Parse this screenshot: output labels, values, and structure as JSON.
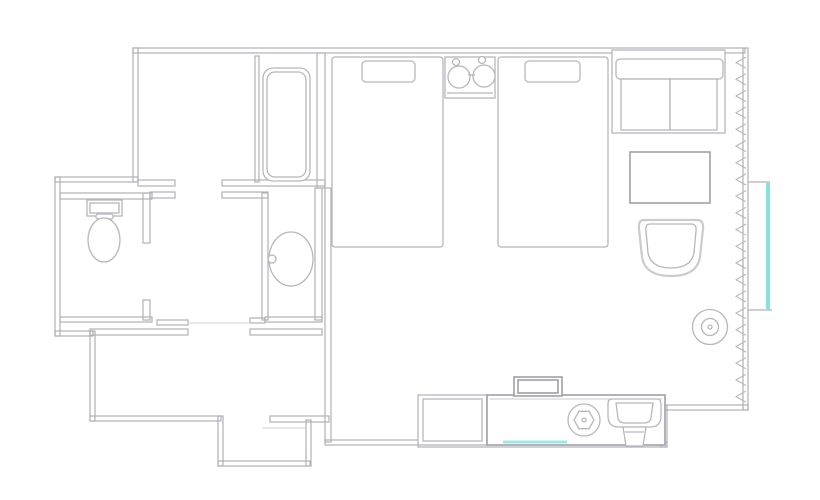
{
  "page": {
    "width": 820,
    "height": 500,
    "background": "#ffffff"
  },
  "colors": {
    "wall": "#b0b1b7",
    "furniture": "#b6b7bd",
    "furniture_dark": "#9fa0a7",
    "soft_outline": "#cbcbd0",
    "door_line": "#dcdcdf",
    "window_glass": "#82e3e0",
    "mirror_glass": "#9fe8e4"
  },
  "floorplan": {
    "type": "hotel-room-floor-plan",
    "elements": [
      {
        "name": "walls",
        "class": "wall",
        "shapes": [
          {
            "t": "rect",
            "x": 133,
            "y": 48,
            "w": 612,
            "h": 5
          },
          {
            "t": "rect",
            "x": 743,
            "y": 48,
            "w": 5,
            "h": 362
          },
          {
            "t": "rect",
            "x": 665,
            "y": 405,
            "w": 83,
            "h": 5
          },
          {
            "t": "rect",
            "x": 661,
            "y": 405,
            "w": 6,
            "h": 42
          },
          {
            "t": "rect",
            "x": 418,
            "y": 442,
            "w": 249,
            "h": 5
          },
          {
            "t": "rect",
            "x": 325,
            "y": 440,
            "w": 95,
            "h": 5
          },
          {
            "t": "rect",
            "x": 325,
            "y": 188,
            "w": 6,
            "h": 254
          },
          {
            "t": "rect",
            "x": 133,
            "y": 48,
            "w": 5,
            "h": 134
          },
          {
            "t": "rect",
            "x": 55,
            "y": 177,
            "w": 83,
            "h": 5
          },
          {
            "t": "rect",
            "x": 55,
            "y": 177,
            "w": 5,
            "h": 159
          },
          {
            "t": "rect",
            "x": 55,
            "y": 331,
            "w": 38,
            "h": 5
          },
          {
            "t": "rect",
            "x": 90,
            "y": 331,
            "w": 5,
            "h": 90
          },
          {
            "t": "rect",
            "x": 90,
            "y": 416,
            "w": 131,
            "h": 5
          },
          {
            "t": "rect",
            "x": 218,
            "y": 416,
            "w": 5,
            "h": 50
          },
          {
            "t": "rect",
            "x": 218,
            "y": 461,
            "w": 92,
            "h": 5
          },
          {
            "t": "rect",
            "x": 306,
            "y": 420,
            "w": 5,
            "h": 46
          },
          {
            "t": "rect",
            "x": 270,
            "y": 416,
            "w": 59,
            "h": 6
          },
          {
            "t": "rect",
            "x": 90,
            "y": 329,
            "w": 98,
            "h": 6
          },
          {
            "t": "rect",
            "x": 250,
            "y": 329,
            "w": 72,
            "h": 6
          },
          {
            "t": "rect",
            "x": 60,
            "y": 317,
            "w": 92,
            "h": 5
          },
          {
            "t": "rect",
            "x": 157,
            "y": 320,
            "w": 31,
            "h": 5
          },
          {
            "t": "rect",
            "x": 250,
            "y": 318,
            "w": 15,
            "h": 5
          },
          {
            "t": "rect",
            "x": 265,
            "y": 317,
            "w": 57,
            "h": 5
          },
          {
            "t": "rect",
            "x": 60,
            "y": 193,
            "w": 92,
            "h": 6
          },
          {
            "t": "rect",
            "x": 143,
            "y": 193,
            "w": 7,
            "h": 50
          },
          {
            "t": "rect",
            "x": 143,
            "y": 300,
            "w": 7,
            "h": 20
          },
          {
            "t": "rect",
            "x": 262,
            "y": 193,
            "w": 6,
            "h": 127
          },
          {
            "t": "rect",
            "x": 315,
            "y": 188,
            "w": 7,
            "h": 132
          },
          {
            "t": "rect",
            "x": 317,
            "y": 53,
            "w": 8,
            "h": 135
          },
          {
            "t": "rect",
            "x": 138,
            "y": 180,
            "w": 37,
            "h": 6
          },
          {
            "t": "rect",
            "x": 222,
            "y": 180,
            "w": 103,
            "h": 6
          },
          {
            "t": "rect",
            "x": 150,
            "y": 192,
            "w": 25,
            "h": 6
          },
          {
            "t": "rect",
            "x": 222,
            "y": 192,
            "w": 46,
            "h": 6
          },
          {
            "t": "rect",
            "x": 255,
            "y": 56,
            "w": 4,
            "h": 126
          }
        ]
      },
      {
        "name": "door-openings",
        "class": "door",
        "shapes": [
          {
            "t": "line",
            "x1": 188,
            "y1": 323,
            "x2": 250,
            "y2": 323
          },
          {
            "t": "line",
            "x1": 262,
            "y1": 428,
            "x2": 305,
            "y2": 428
          }
        ]
      },
      {
        "name": "bathtub",
        "class": "furn",
        "shapes": [
          {
            "t": "rect",
            "x": 263,
            "y": 68,
            "w": 47,
            "h": 113,
            "rx": 10,
            "f": "#ffffff"
          },
          {
            "t": "rect",
            "x": 267,
            "y": 72,
            "w": 39,
            "h": 105,
            "rx": 8
          }
        ]
      },
      {
        "name": "toilet",
        "class": "furn",
        "shapes": [
          {
            "t": "rect",
            "x": 87,
            "y": 200,
            "w": 35,
            "h": 16,
            "f": "#ffffff"
          },
          {
            "t": "rect",
            "x": 90,
            "y": 203,
            "w": 29,
            "h": 10
          },
          {
            "t": "rect",
            "x": 96,
            "y": 214,
            "w": 17,
            "h": 5,
            "rx": 2,
            "f": "#ffffff"
          },
          {
            "t": "ellipse",
            "cx": 104,
            "cy": 240,
            "rx": 16,
            "ry": 22,
            "f": "#ffffff"
          }
        ]
      },
      {
        "name": "washbasin",
        "class": "furn",
        "shapes": [
          {
            "t": "ellipse",
            "cx": 291,
            "cy": 259,
            "rx": 22,
            "ry": 27,
            "f": "#ffffff"
          },
          {
            "t": "circle",
            "cx": 272,
            "cy": 259,
            "r": 4,
            "f": "#ffffff"
          }
        ]
      },
      {
        "name": "bed-1",
        "class": "furn",
        "shapes": [
          {
            "t": "rect",
            "x": 332,
            "y": 57,
            "w": 111,
            "h": 190,
            "rx": 3,
            "f": "#ffffff"
          },
          {
            "t": "rect",
            "x": 362,
            "y": 61,
            "w": 53,
            "h": 21,
            "rx": 4,
            "f": "#ffffff"
          }
        ]
      },
      {
        "name": "bed-2",
        "class": "furn",
        "shapes": [
          {
            "t": "rect",
            "x": 498,
            "y": 57,
            "w": 110,
            "h": 190,
            "rx": 3,
            "f": "#ffffff"
          },
          {
            "t": "rect",
            "x": 525,
            "y": 61,
            "w": 55,
            "h": 21,
            "rx": 4,
            "f": "#ffffff"
          }
        ]
      },
      {
        "name": "nightstand-lamps",
        "class": "furn",
        "shapes": [
          {
            "t": "rect",
            "x": 445,
            "y": 57,
            "w": 50,
            "h": 41,
            "f": "#ffffff"
          },
          {
            "t": "line",
            "x1": 447,
            "y1": 93,
            "x2": 493,
            "y2": 93
          },
          {
            "t": "circle",
            "cx": 459,
            "cy": 77,
            "r": 11,
            "f": "#ffffff"
          },
          {
            "t": "circle",
            "cx": 484,
            "cy": 76,
            "r": 11,
            "f": "#ffffff"
          },
          {
            "t": "circle",
            "cx": 456,
            "cy": 62,
            "r": 3.5,
            "f": "#ffffff"
          },
          {
            "t": "circle",
            "cx": 482,
            "cy": 60,
            "r": 3.5,
            "f": "#ffffff"
          },
          {
            "t": "line",
            "x1": 468,
            "y1": 75,
            "x2": 475,
            "y2": 75
          }
        ]
      },
      {
        "name": "sofa",
        "class": "furn",
        "shapes": [
          {
            "t": "rect",
            "x": 612,
            "y": 50,
            "w": 113,
            "h": 83,
            "f": "#ffffff"
          },
          {
            "t": "rect",
            "x": 616,
            "y": 59,
            "w": 107,
            "h": 20,
            "rx": 4,
            "f": "#ffffff"
          },
          {
            "t": "rect",
            "x": 621,
            "y": 79,
            "w": 49,
            "h": 51,
            "f": "#ffffff"
          },
          {
            "t": "rect",
            "x": 670,
            "y": 79,
            "w": 47,
            "h": 51,
            "f": "#ffffff"
          }
        ]
      },
      {
        "name": "coffee-table",
        "class": "furn2",
        "shapes": [
          {
            "t": "rect",
            "x": 630,
            "y": 152,
            "w": 80,
            "h": 51,
            "f": "#ffffff"
          }
        ]
      },
      {
        "name": "armchair",
        "class": "furn",
        "shapes": [
          {
            "t": "path",
            "d": "M644 220 H697 Q704 220 703 229 L700 257 Q697 276 671 276 Q645 276 642 257 L639 229 Q638 220 644 220 Z",
            "s": "#cbcbd0",
            "sw": 2.2,
            "f": "#ffffff"
          },
          {
            "t": "path",
            "d": "M650 224 H691 Q697 224 696 231 L694 253 Q691 268 671 268 Q651 268 648 253 L646 231 Q645 224 650 224 Z",
            "f": "#ffffff"
          }
        ]
      },
      {
        "name": "round-side-table",
        "class": "furn",
        "shapes": [
          {
            "t": "circle",
            "cx": 710,
            "cy": 327,
            "r": 17.5,
            "f": "#ffffff"
          },
          {
            "t": "circle",
            "cx": 710,
            "cy": 327,
            "r": 8.5
          },
          {
            "t": "circle",
            "cx": 710,
            "cy": 327,
            "r": 2
          }
        ]
      },
      {
        "name": "counter-cabinet",
        "class": "furn",
        "shapes": [
          {
            "t": "rect",
            "x": 418,
            "y": 395,
            "w": 69,
            "h": 50,
            "f": "#ffffff"
          },
          {
            "t": "rect",
            "x": 423,
            "y": 399,
            "w": 59,
            "h": 42
          }
        ]
      },
      {
        "name": "vanity-counter",
        "class": "furn2",
        "shapes": [
          {
            "t": "rect",
            "x": 487,
            "y": 395,
            "w": 178,
            "h": 50,
            "f": "#ffffff"
          },
          {
            "t": "line",
            "x1": 490,
            "y1": 399,
            "x2": 662,
            "y2": 399,
            "s": "#cbcbd0",
            "sw": 1
          }
        ]
      },
      {
        "name": "tv",
        "class": "furn2",
        "shapes": [
          {
            "t": "rect",
            "x": 514,
            "y": 377,
            "w": 48,
            "h": 19,
            "f": "#ffffff"
          },
          {
            "t": "rect",
            "x": 518,
            "y": 380,
            "w": 40,
            "h": 13
          }
        ]
      },
      {
        "name": "kettle",
        "class": "furn",
        "shapes": [
          {
            "t": "circle",
            "cx": 584,
            "cy": 420,
            "r": 16,
            "f": "#ffffff"
          },
          {
            "t": "polygon",
            "points": "594,420 589,428.7 579,428.7 574,420 579,411.3 589,411.3",
            "f": "#ffffff"
          },
          {
            "t": "circle",
            "cx": 584,
            "cy": 420,
            "r": 2
          }
        ]
      },
      {
        "name": "sink",
        "class": "furn",
        "shapes": [
          {
            "t": "path",
            "d": "M612 399 H657 Q661 399 661 404 V416 Q661 427 650 427 H619 Q608 427 608 416 V404 Q608 399 612 399 Z",
            "f": "#ffffff"
          },
          {
            "t": "path",
            "d": "M616 403 H653 L651 418 Q650 423 644 423 H625 Q619 423 618 418 Z",
            "f": "#ffffff"
          },
          {
            "t": "path",
            "d": "M623 427 H646 L643 446 H626 Z",
            "f": "#ffffff"
          },
          {
            "t": "line",
            "x1": 625,
            "y1": 432,
            "x2": 644,
            "y2": 432
          }
        ]
      },
      {
        "name": "vanity-mirror",
        "class": "glass",
        "shapes": [
          {
            "t": "line",
            "x1": 503,
            "y1": 442,
            "x2": 567,
            "y2": 442,
            "s": "#9fe8e4",
            "sw": 3
          }
        ]
      },
      {
        "name": "window",
        "class": "glass",
        "shapes": [
          {
            "t": "line",
            "x1": 748,
            "y1": 182,
            "x2": 770,
            "y2": 182,
            "s": "#b0b1b7",
            "sw": 1.2
          },
          {
            "t": "line",
            "x1": 748,
            "y1": 310,
            "x2": 772,
            "y2": 310,
            "s": "#b0b1b7",
            "sw": 1.2
          },
          {
            "t": "rect",
            "x": 766,
            "y": 183,
            "w": 4,
            "h": 127,
            "f": "#82e3e0"
          }
        ]
      },
      {
        "name": "curtain",
        "class": "furn",
        "shapes": [
          {
            "t": "path",
            "d": "M746 0 L736 5.6 L746 11.2",
            "sw": 1.1,
            "repeat": {
              "n": 21,
              "y0": 57,
              "dy": 16.7
            }
          }
        ]
      }
    ]
  }
}
